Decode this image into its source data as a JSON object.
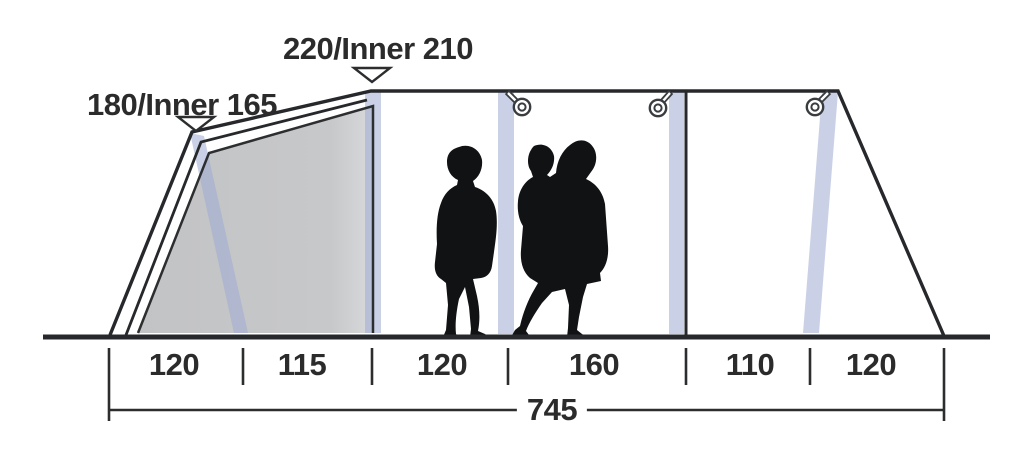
{
  "diagram": {
    "type": "tent-side-profile-dimension-diagram",
    "height_labels": [
      {
        "id": "front-section-height",
        "text": "180/Inner 165"
      },
      {
        "id": "main-section-height",
        "text": "220/Inner 210"
      }
    ],
    "width_segments_cm": [
      {
        "label": "120"
      },
      {
        "label": "115"
      },
      {
        "label": "120"
      },
      {
        "label": "160"
      },
      {
        "label": "110"
      },
      {
        "label": "120"
      }
    ],
    "total_width_cm": {
      "label": "745"
    },
    "icons": [
      "pointer-triangle-icon",
      "lantern-hook-icon",
      "person-silhouette",
      "adult-with-child-silhouette"
    ],
    "colors": {
      "line": "#2a2c2e",
      "text": "#2b2b2b",
      "inner_tent_panel": "#c5c6c7",
      "air_pole": "#ccd5ea"
    }
  }
}
